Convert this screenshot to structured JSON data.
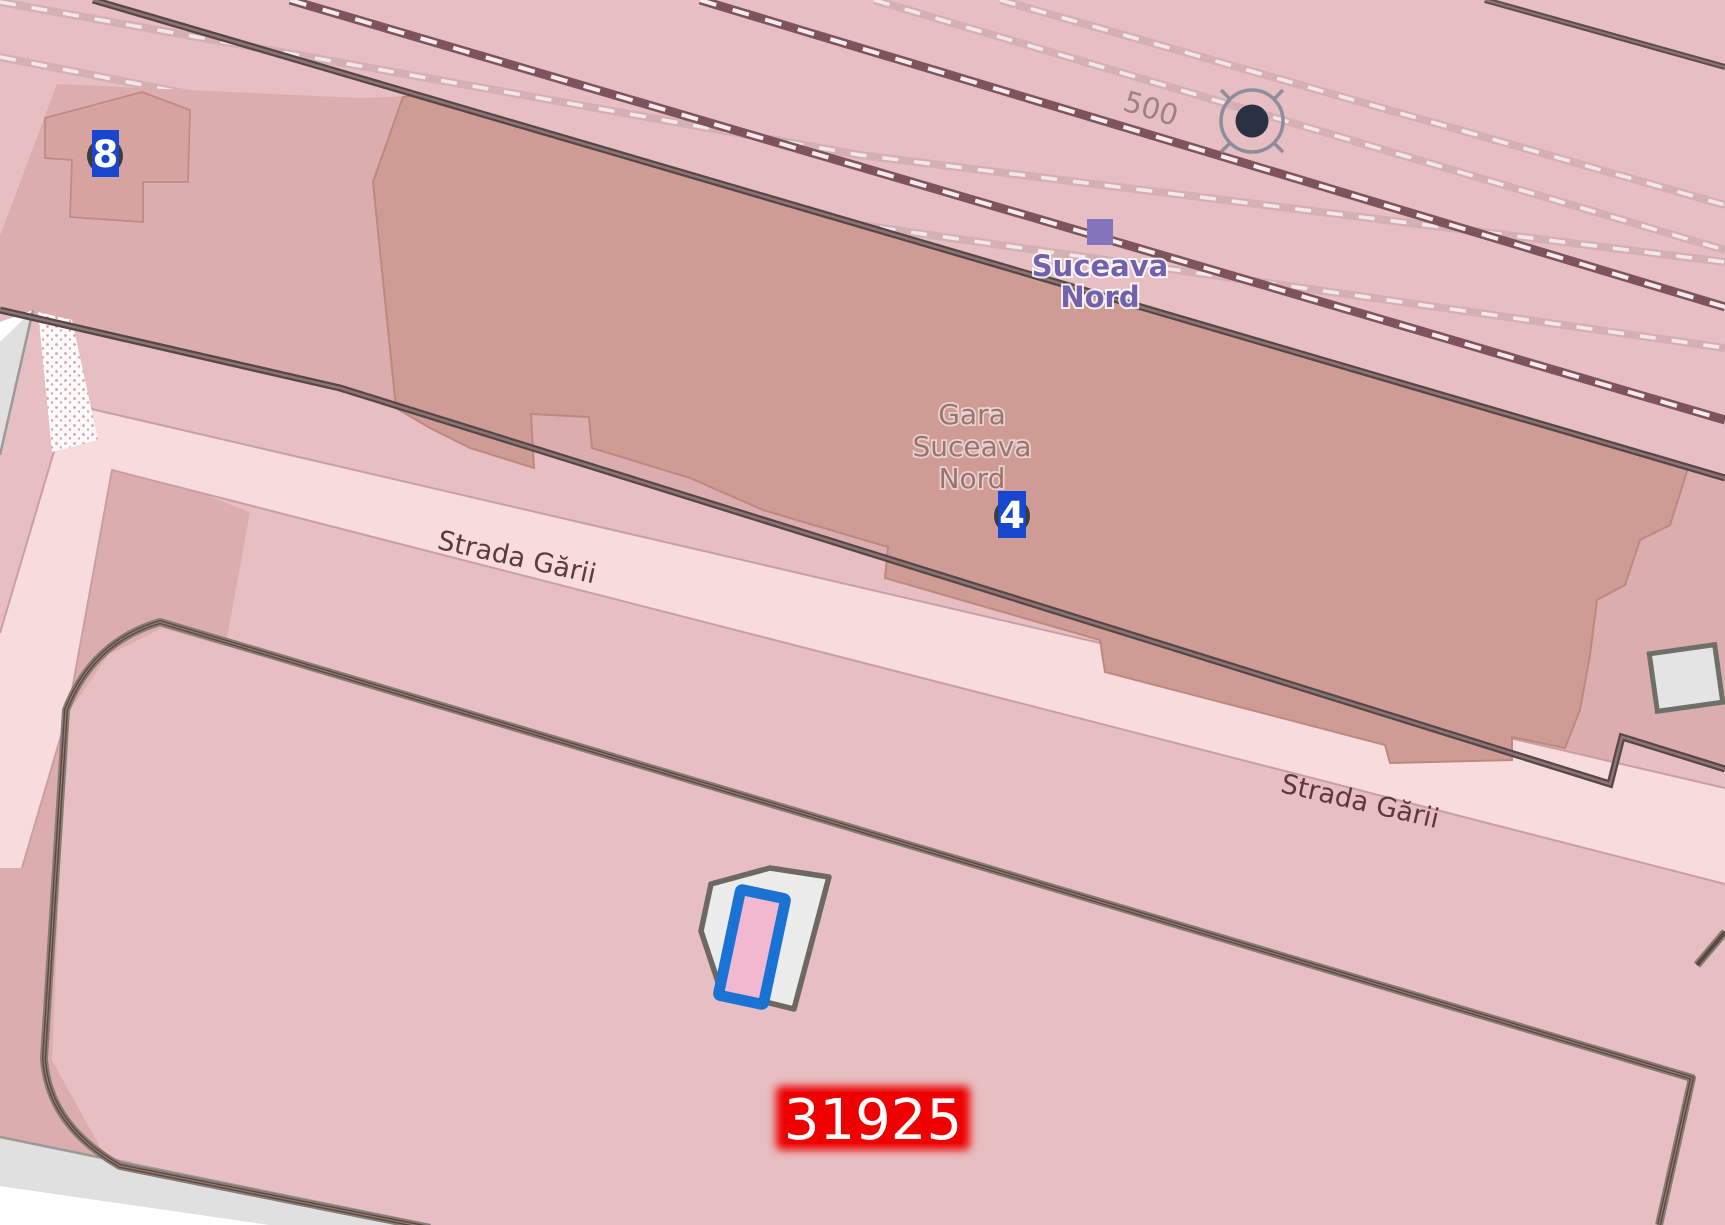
{
  "labels": {
    "track_ref": "500",
    "station": {
      "line1": "Suceava",
      "line2": "Nord"
    },
    "station_building": {
      "line1": "Gara",
      "line2": "Suceava",
      "line3": "Nord"
    },
    "street_left": "Strada Gării",
    "street_right": "Strada Gării",
    "parcel_ref": "31925",
    "marker_left": "8",
    "marker_center": "4"
  },
  "colors": {
    "background_pink": "#e7bec1",
    "railway_landuse_pink": "#dcadae",
    "station_building_fill": "#cf9c95",
    "station_building_border": "#bd897f",
    "road_fill": "#f8dbdd",
    "road_casing": "#c8a0a4",
    "rail_dark": "#7e545c",
    "rail_faint": "#d4b0b4",
    "fence_line": "#5a4a43",
    "gray_road": "#e0e0e0",
    "marker_blue": "#1747cf",
    "station_label_purple": "#7262ae",
    "building_label_brown": "#9b7470",
    "street_label_maroon": "#5c393d",
    "ref_label_red": "#ee0000",
    "highlight_stroke_blue": "#1a72d2",
    "highlight_fill_pink": "#f2b8cf"
  },
  "icons": {
    "station_square": "railway-station-square-icon",
    "turntable_circle": "railway-stop-circle-icon",
    "marker_pins": "numbered-marker-icon"
  }
}
